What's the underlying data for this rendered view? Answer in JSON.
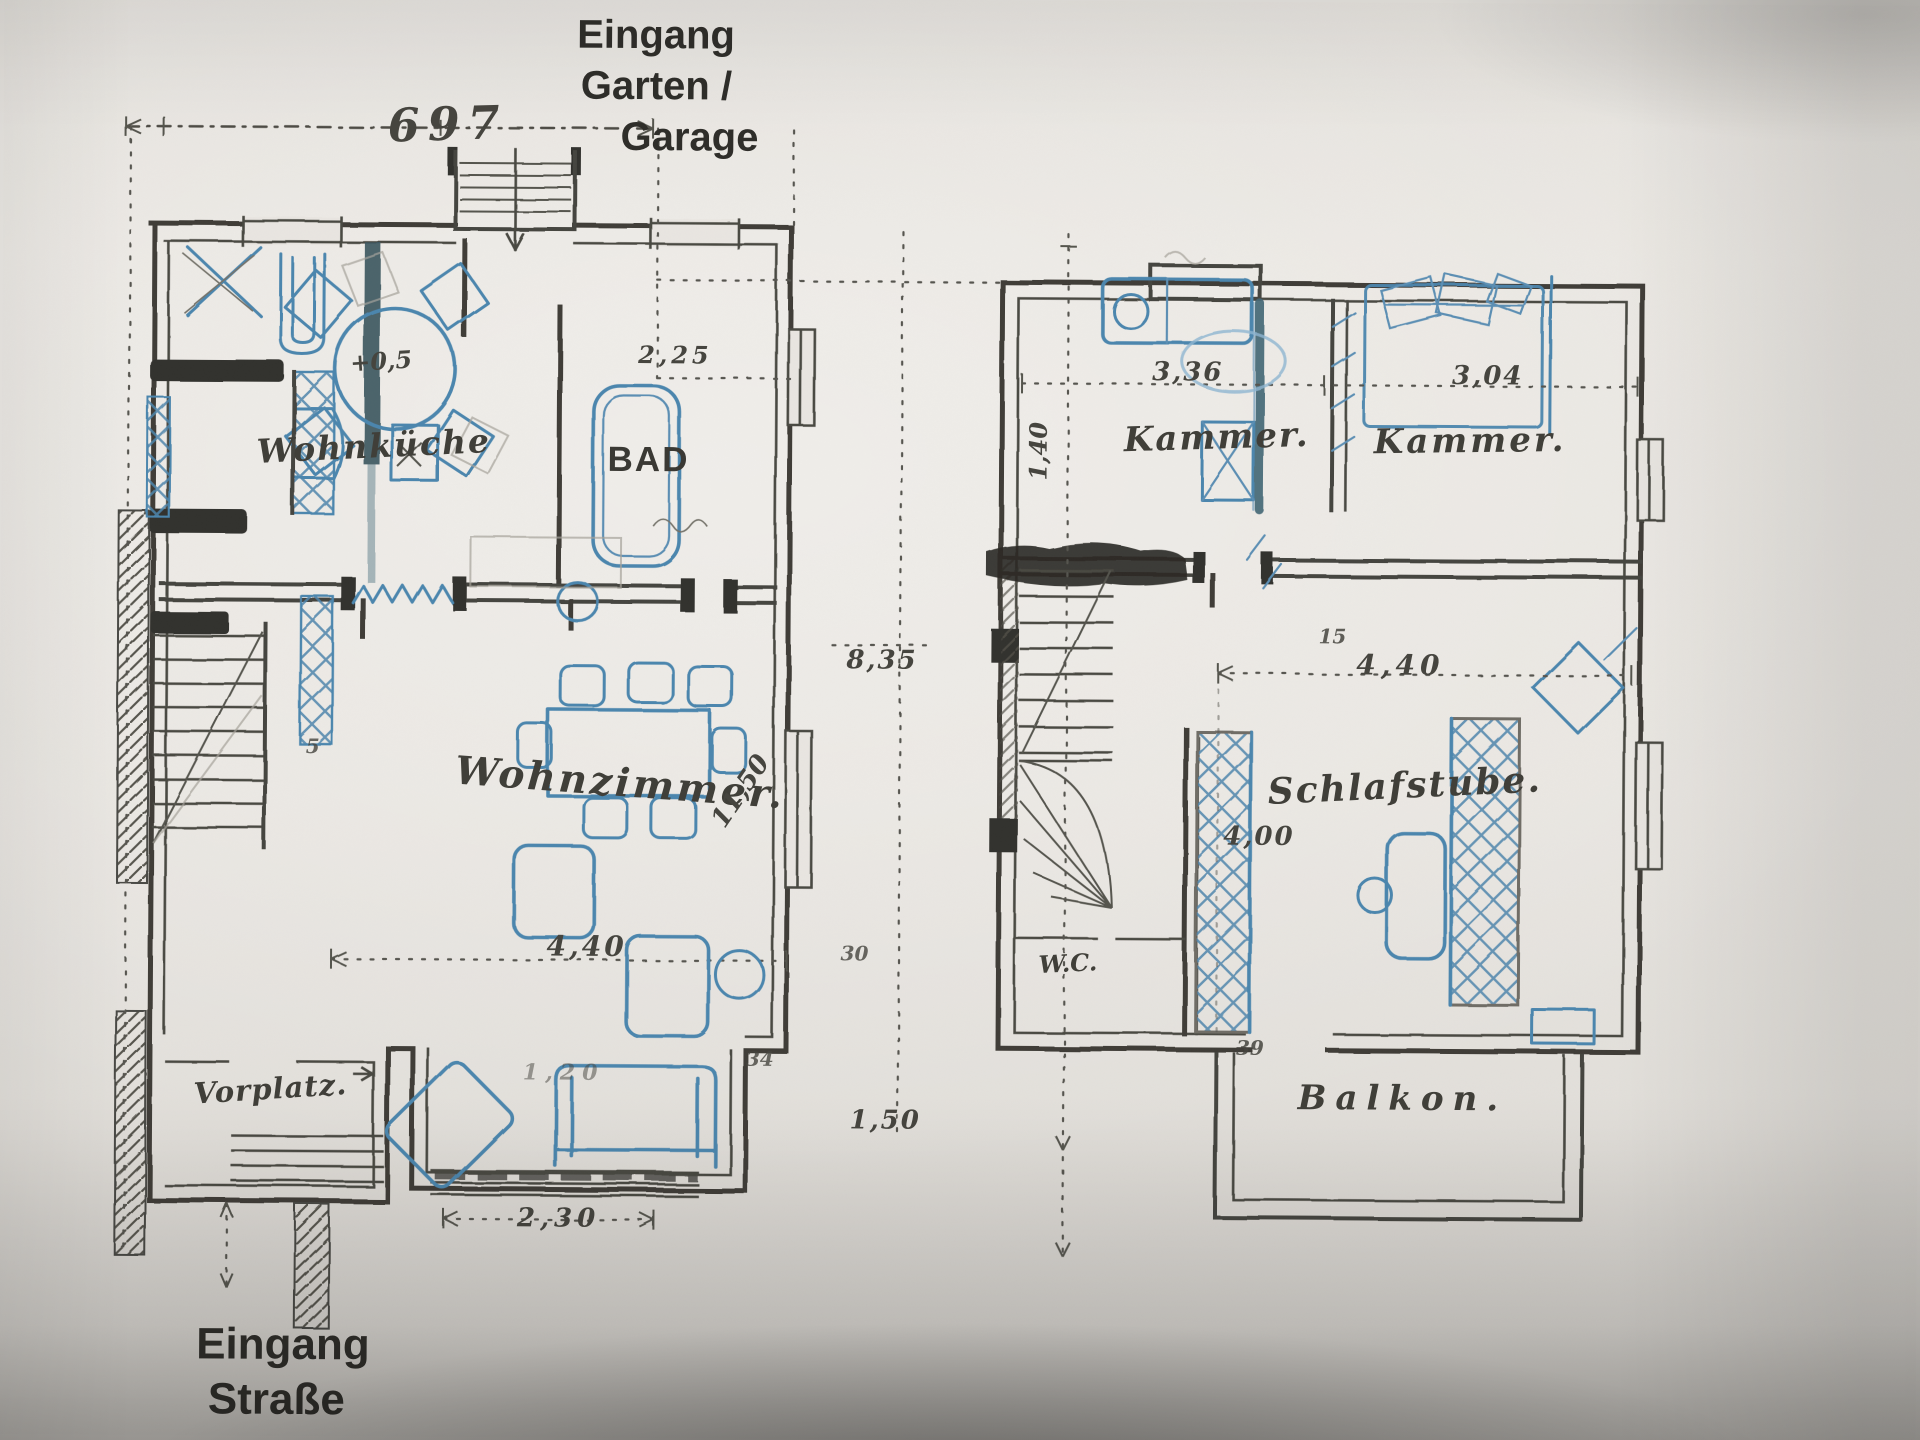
{
  "colors": {
    "paper": "#e9e6e1",
    "ink": "#3f3e39",
    "pencil_blue": "#4c86ae",
    "pencil_teal": "#456876",
    "printed_text": "#2f2e2a"
  },
  "top_annotation": {
    "line1": "Eingang",
    "line2": "Garten /",
    "line3": "Garage"
  },
  "bottom_annotation": {
    "line1": "Eingang",
    "line2": "Straße"
  },
  "ground_floor": {
    "rooms": {
      "kitchen": "Wohnküche",
      "bath": "BAD",
      "living": "Wohnzimmer.",
      "vestibule": "Vorplatz."
    },
    "dimensions": {
      "overall_width": "697",
      "bath_width": "2,25",
      "level_mark": "+0,5",
      "house_depth": "8,35",
      "living_width": "4,40",
      "living_depth": "11,50",
      "bay_width": "2,30",
      "bay_note": "1,20",
      "offset_right": "1,50",
      "wall_tick_a": "30",
      "wall_tick_b": "34",
      "wall_tick_c": "5"
    }
  },
  "upper_floor": {
    "rooms": {
      "chamber_left": "Kammer.",
      "chamber_right": "Kammer.",
      "bedroom": "Schlafstube.",
      "wc": "W.C.",
      "balcony": "Balkon."
    },
    "dimensions": {
      "chamber_left_width": "3,36",
      "chamber_right_width": "3,04",
      "bedroom_width": "4,40",
      "bedroom_depth": "4,00",
      "side_depth": "1,40",
      "wall_tick_a": "15",
      "wall_tick_b": "39"
    }
  }
}
